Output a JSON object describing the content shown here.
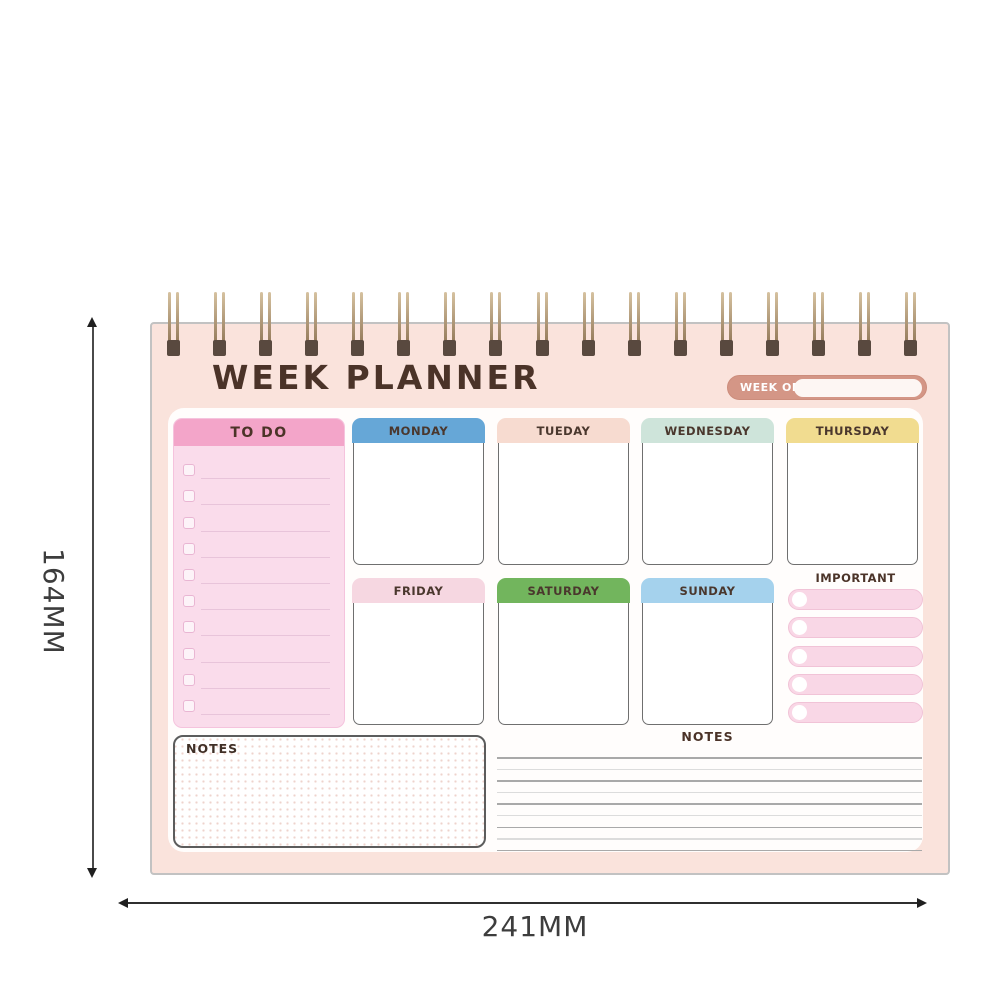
{
  "planner": {
    "title": "WEEK PLANNER",
    "week_of": {
      "label": "WEEK OF:",
      "value": ""
    },
    "todo": {
      "label": "TO DO",
      "row_count": 10
    },
    "days_row1": [
      {
        "label": "MONDAY",
        "color": "#66a7d7",
        "style": "--c:#66a7d7"
      },
      {
        "label": "TUEDAY",
        "color": "#f7dbd0",
        "style": "--c:#f7dbd0"
      },
      {
        "label": "WEDNESDAY",
        "color": "#cee4da",
        "style": "--c:#cee4da"
      },
      {
        "label": "THURSDAY",
        "color": "#f1dc90",
        "style": "--c:#f1dc90"
      }
    ],
    "days_row2": [
      {
        "label": "FRIDAY",
        "color": "#f6d7e1",
        "style": "--c:#f6d7e1"
      },
      {
        "label": "SATURDAY",
        "color": "#72b55d",
        "style": "--c:#72b55d"
      },
      {
        "label": "SUNDAY",
        "color": "#a5d2ed",
        "style": "--c:#a5d2ed"
      }
    ],
    "important": {
      "label": "IMPORTANT",
      "row_count": 5
    },
    "notes_left": {
      "label": "NOTES"
    },
    "notes_right": {
      "label": "NOTES",
      "line_count": 9
    }
  },
  "dimensions": {
    "height": "164MM",
    "width": "241MM"
  },
  "colors": {
    "page_bg": "#fae3dc",
    "panel_bg": "#fffdfc",
    "text_brown": "#4b3328",
    "week_of_bg": "#d49686",
    "todo_header": "#f3a5c9",
    "todo_body": "#fadceb",
    "important_pill": "#f9d7e6",
    "binding_wire": "#a9916f",
    "binding_punch": "#59493f",
    "dimension_line": "#2f2f2f"
  }
}
